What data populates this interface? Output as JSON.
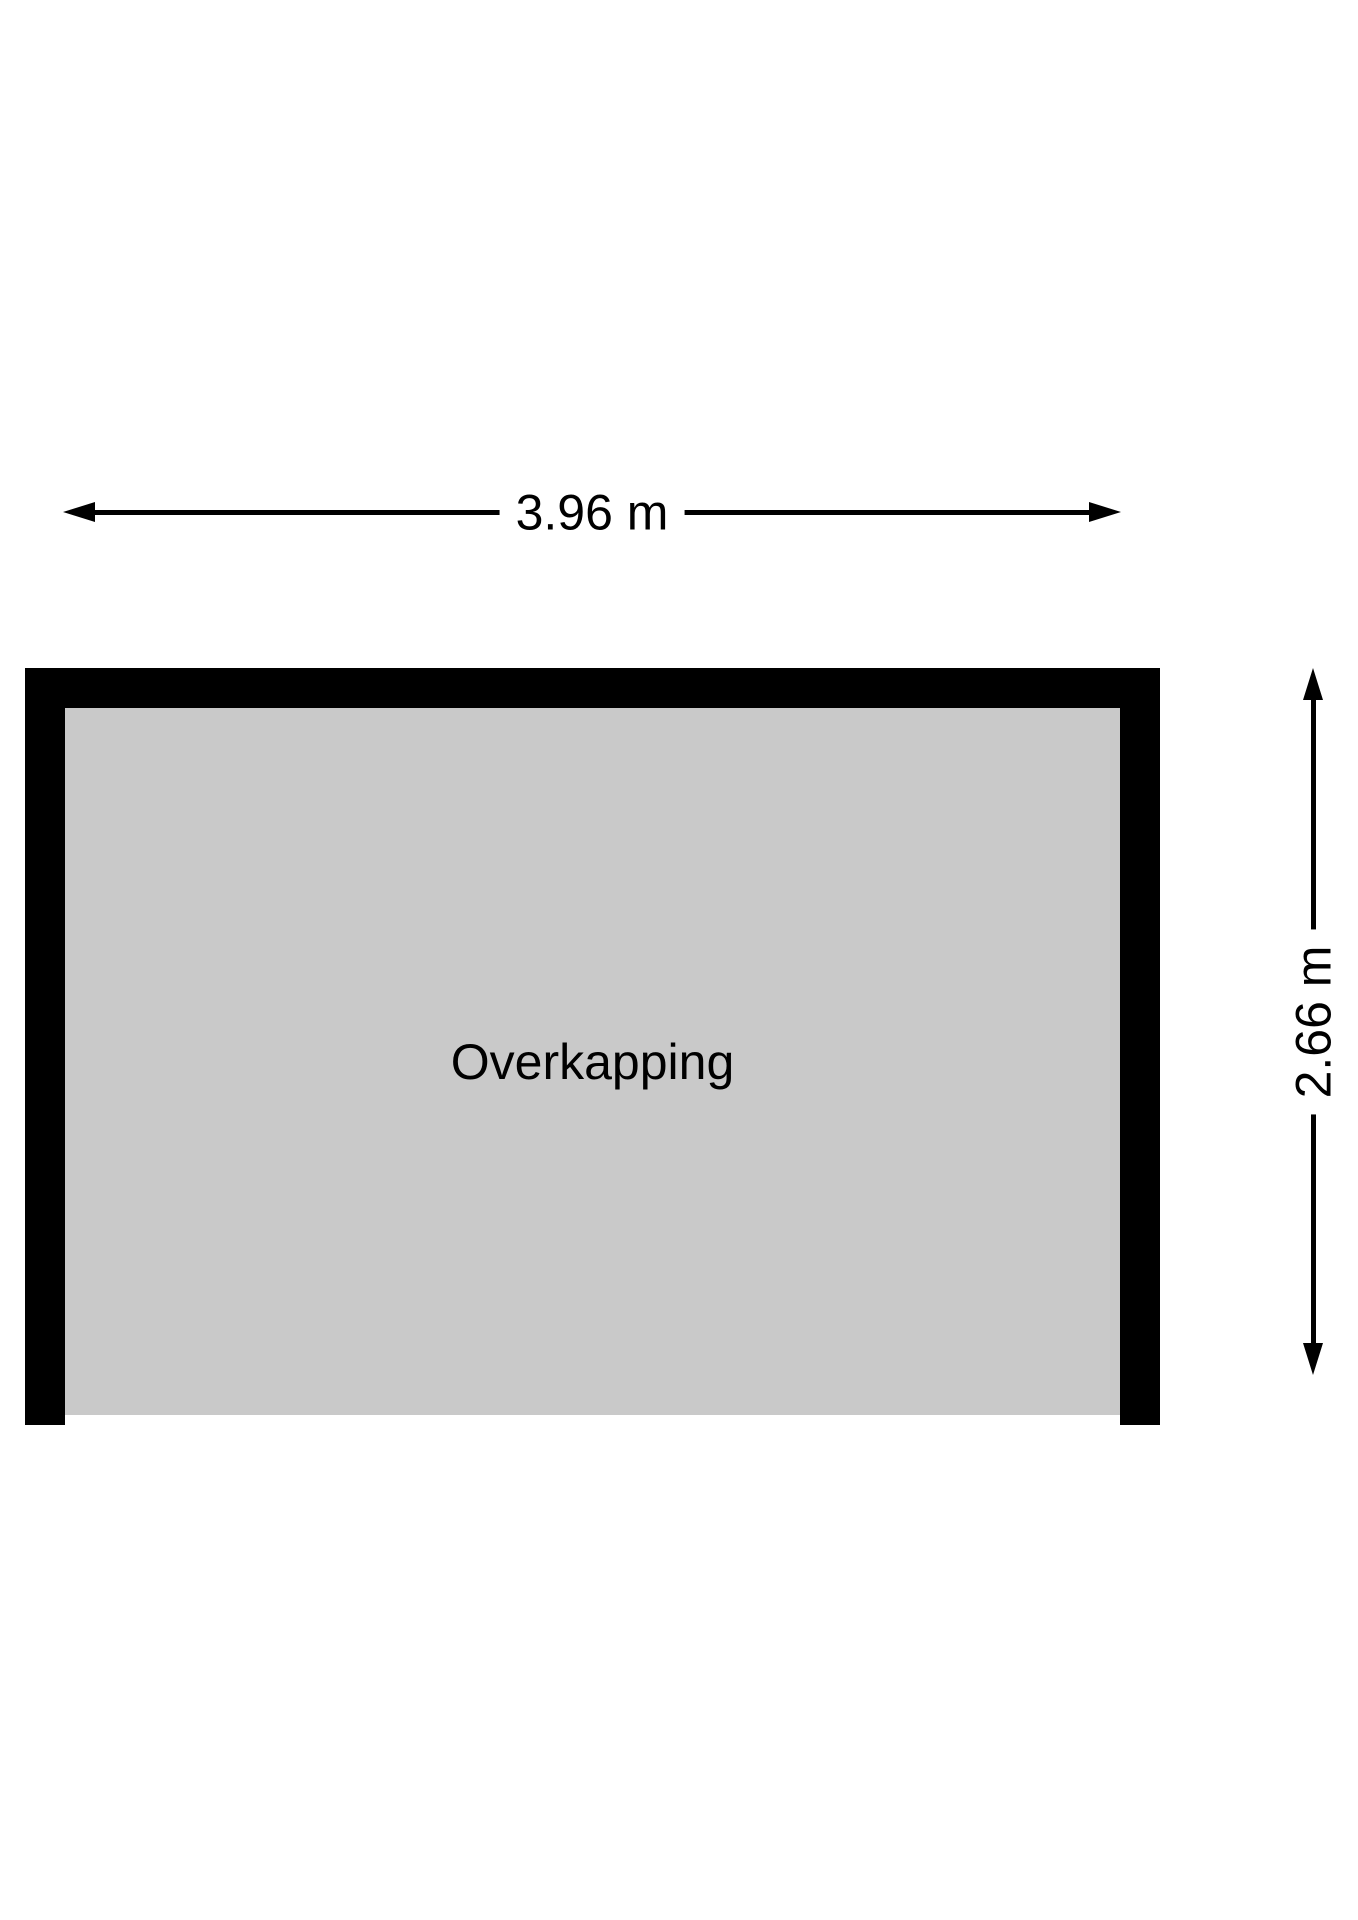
{
  "floor_plan": {
    "room": {
      "label": "Overkapping"
    },
    "dimensions": {
      "width": {
        "label": "3.96 m",
        "value_m": 3.96
      },
      "height": {
        "label": "2.66 m",
        "value_m": 2.66
      }
    },
    "colors": {
      "wall": "#000000",
      "floor": "#c9c9c9",
      "background": "#ffffff",
      "text": "#000000"
    }
  }
}
